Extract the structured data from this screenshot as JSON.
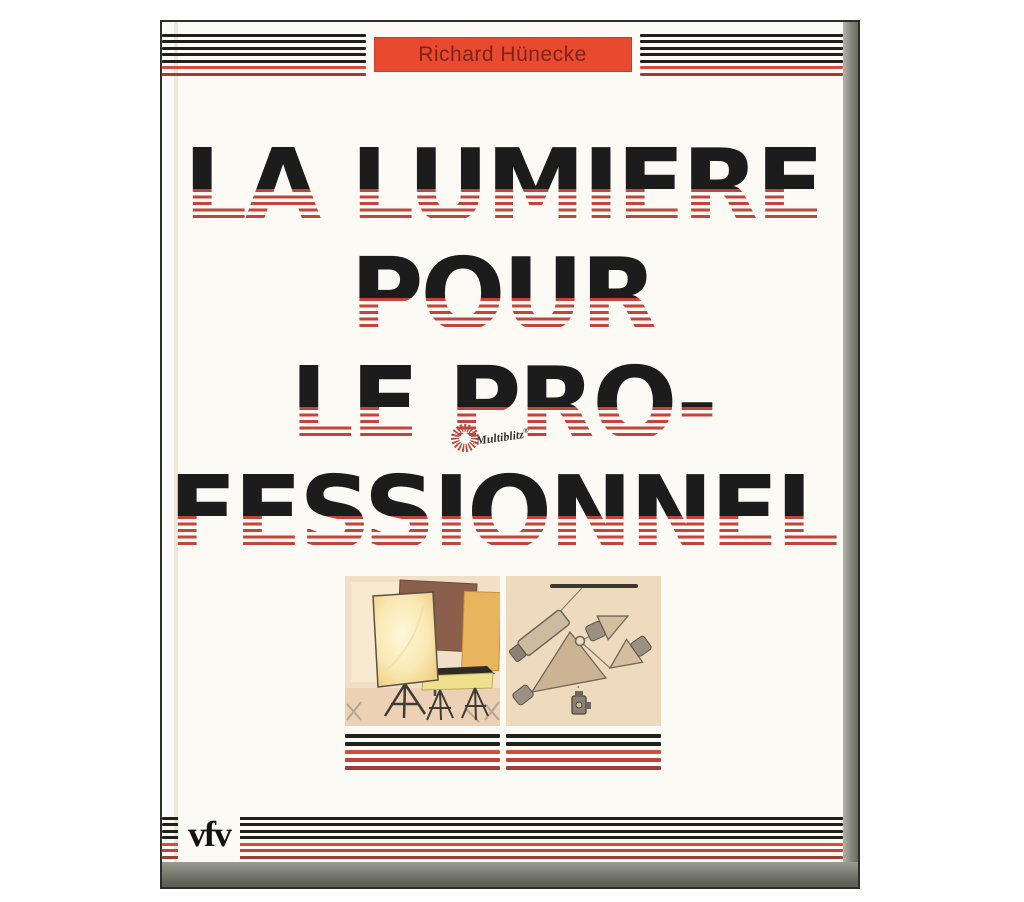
{
  "cover": {
    "author_banner": {
      "text": "Richard Hünecke"
    },
    "title_lines": [
      "LA LUMIERE",
      "POUR",
      "LE PRO-",
      "FESSIONNEL"
    ],
    "multiblitz": {
      "name": "Multiblitz",
      "registered_mark": "®"
    },
    "publisher_logo_text": "vfv",
    "illustrations": {
      "left": "Studio lighting equipment illustration",
      "right": "Lighting setup diagram"
    },
    "colors": {
      "banner_red": "#e8492f",
      "stripe_black": "#21201d",
      "stripe_red": "#cf4f3d",
      "title_black": "#1c1c1c",
      "title_stripe_red": "#c2453c",
      "illustration_beige": "#f0dcc2"
    }
  }
}
